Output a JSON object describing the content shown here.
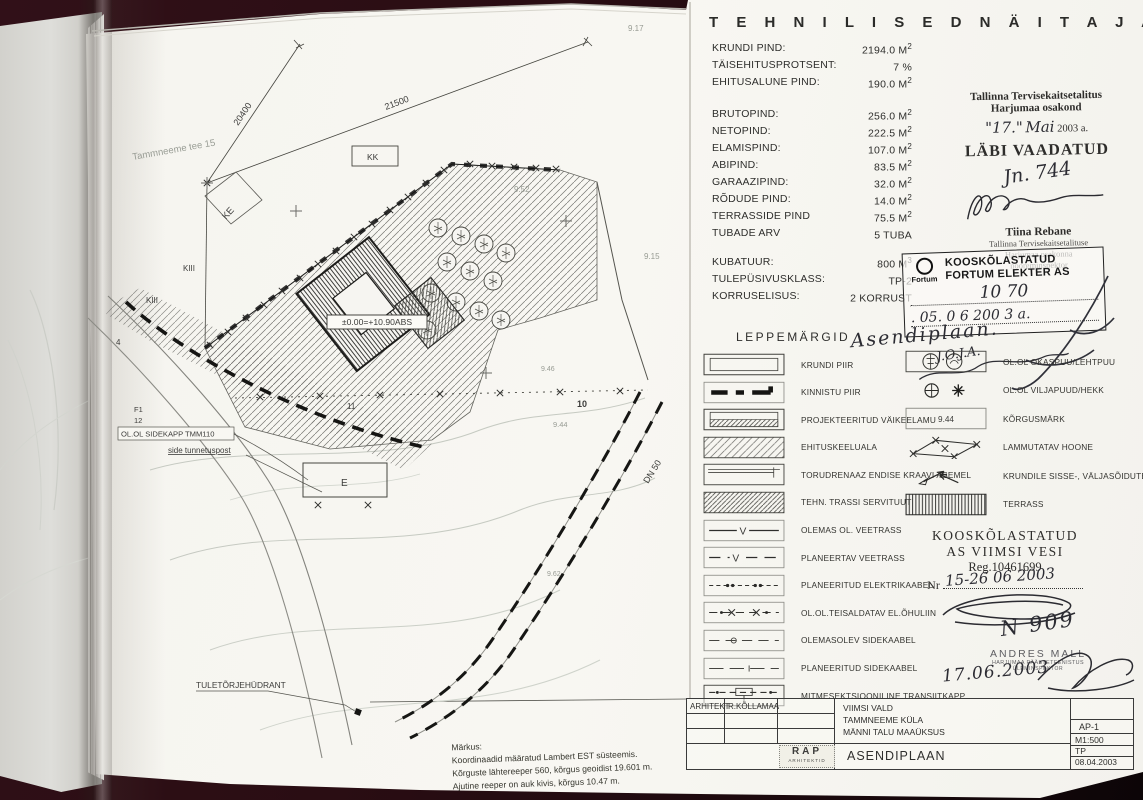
{
  "tech": {
    "title": "T E H N I L I S E D   N Ä I T A J A D :",
    "rows": [
      {
        "label": "KRUNDI PIND:",
        "value": "2194.0 M",
        "sup": "2"
      },
      {
        "label": "TÄISEHITUSPROTSENT:",
        "value": "7 %",
        "sup": ""
      },
      {
        "label": "EHITUSALUNE PIND:",
        "value": "190.0 M",
        "sup": "2"
      },
      {
        "label": "BRUTOPIND:",
        "value": "256.0 M",
        "sup": "2"
      },
      {
        "label": "NETOPIND:",
        "value": "222.5 M",
        "sup": "2"
      },
      {
        "label": "ELAMISPIND:",
        "value": "107.0 M",
        "sup": "2"
      },
      {
        "label": "ABIPIND:",
        "value": "83.5 M",
        "sup": "2"
      },
      {
        "label": "GARAAZIPIND:",
        "value": "32.0 M",
        "sup": "2"
      },
      {
        "label": "RÕDUDE PIND:",
        "value": "14.0 M",
        "sup": "2"
      },
      {
        "label": "TERRASSIDE PIND",
        "value": "75.5 M",
        "sup": "2"
      },
      {
        "label": "TUBADE ARV",
        "value": "5 TUBA",
        "sup": ""
      },
      {
        "label": "KUBATUUR:",
        "value": "800 M",
        "sup": "3"
      },
      {
        "label": "TULEPÜSIVUSKLASS:",
        "value": "TP-2",
        "sup": ""
      },
      {
        "label": "KORRUSELISUS:",
        "value": "2 KORRUST",
        "sup": ""
      }
    ]
  },
  "stamps": {
    "tervise": {
      "line1": "Tallinna Tervisekaitsetalitus",
      "line2": "Harjumaa osakond",
      "day": "\"17.\"",
      "month": "Mai",
      "year": "2003 a.",
      "labi": "LÄBI VAADATUD",
      "nr_hand": "Jn. 744",
      "name": "Tiina Rebane",
      "sub1": "Tallinna Tervisekaitsetalituse",
      "sub2": "Harjumaa osakonna",
      "sub3": "nooreminspektor"
    },
    "fortum": {
      "brand": "Fortum",
      "line1": "KOOSKÕLASTATUD",
      "line2": "FORTUM ELEKTER AS",
      "hand_nr": "10 70",
      "hand_date": ". 05.   0 6  200 3  a."
    },
    "handnote": {
      "n1": "Asendiplaan.",
      "n2": "J.O.J.A."
    }
  },
  "legend": {
    "title": "LEPPEMÄRGID",
    "left": [
      {
        "label": "KRUNDI PIIR"
      },
      {
        "label": "KINNISTU PIIR"
      },
      {
        "label": "PROJEKTEERITUD VÄIKEELAMU"
      },
      {
        "label": "EHITUSKEELUALA"
      },
      {
        "label": "TORUDRENAAZ ENDISE KRAAVI ASEMEL"
      },
      {
        "label": "TEHN. TRASSI SERVITUUT"
      },
      {
        "label": "OLEMAS OL. VEETRASS",
        "glyph": "V"
      },
      {
        "label": "PLANEERTAV VEETRASS",
        "glyph": "V"
      },
      {
        "label": "PLANEERITUD ELEKTRIKAABEL"
      },
      {
        "label": "OL.OL.TEISALDATAV EL.ÕHULIIN"
      },
      {
        "label": "OLEMASOLEV SIDEKAABEL"
      },
      {
        "label": "PLANEERITUD SIDEKAABEL"
      },
      {
        "label": "MITMESEKTSIOONILINE TRANSIITKAPP"
      }
    ],
    "right": [
      {
        "label": "OL.OL OKASPUU/LEHTPUU"
      },
      {
        "label": "OL.OL VILJAPUUD/HEKK"
      },
      {
        "label": "KÕRGUSMÄRK",
        "glyph": "9.44"
      },
      {
        "label": "LAMMUTATAV HOONE"
      },
      {
        "label": "KRUNDILE SISSE-, VÄLJASÕIDUTEE"
      },
      {
        "label": "TERRASS"
      }
    ]
  },
  "viimsi": {
    "t1": "KOOSKÕLASTATUD",
    "t2": "AS VIIMSI VESI",
    "t3": "Reg.10461699",
    "nr": "Nr",
    "hand_date": "15-26  06  2003",
    "hand_n": "N 909"
  },
  "mall": {
    "name": "ANDRES MALL",
    "sub1": "HARJUMAA PÄÄSTETEENISTUS",
    "sub2": "ÜLEMINSPEKTOR",
    "hand_date": "17.06.2003"
  },
  "titleblock": {
    "role": "ARHITEKT",
    "name": "R.KÕLLAMAA",
    "loc1": "VIIMSI VALD",
    "loc2": "TAMMNEEME KÜLA",
    "loc3": "MÄNNI TALU MAAÜKSUS",
    "drawing": "ASENDIPLAAN",
    "logo1": "RAP",
    "logo2": "ARHITEKTID",
    "code": "AP-1",
    "scale": "M1:500",
    "stage": "TP",
    "date": "08.04.2003"
  },
  "note": {
    "title": "Märkus:",
    "l1": "Koordinaadid määratud Lambert EST süsteemis.",
    "l2": "Kõrguste lähtereeper 560, kõrgus geoidist 19.601 m.",
    "l3": "Ajutine reeper on auk kivis, kõrgus 10.47 m."
  },
  "plan": {
    "labels": {
      "street": "Tammneeme tee 15",
      "d21500": "21500",
      "d20400": "20400",
      "kk": "KK",
      "ke": "KE",
      "kiii_a": "KIII",
      "kiii_b": "KIII",
      "n4": "4",
      "f1": "F1",
      "n12": "12",
      "sidekapp": "OL.OL SIDEKAPP TMM110",
      "tunnetus": "side tunnetuspost",
      "e": "E",
      "elev": "±0.00=+10.90ABS",
      "hydrant": "TULETÕRJEHÜDRANT",
      "dn50": "DN 50",
      "n10": "10",
      "n11": "11",
      "h917": "9.17",
      "h952": "9.52",
      "h915": "9.15",
      "h944": "9.44",
      "h946": "9.46",
      "h962": "9.62"
    }
  }
}
